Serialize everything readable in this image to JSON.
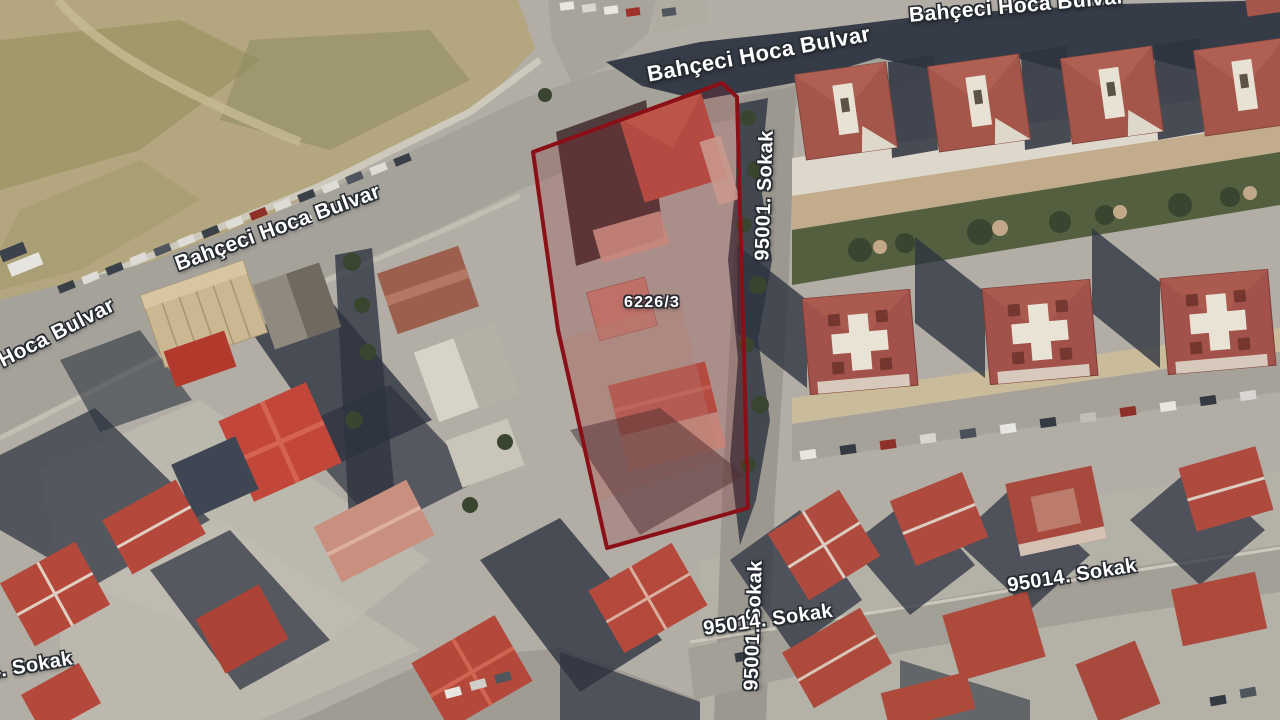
{
  "map": {
    "type": "satellite-cadastral-view",
    "parcel": {
      "id": "6226/3",
      "outline_color": "#8b0f16"
    },
    "streets": {
      "boulevard": "Bahçeci Hoca Bulvar",
      "street_95001": "95001. Sokak",
      "street_95014": "95014. Sokak",
      "corner_fragment": "96"
    },
    "colors": {
      "ground": "#b2aea6",
      "field": "#b4a67e",
      "road": "#a5a29a",
      "shadow": "#2d3340",
      "roof_red": "#b4483a",
      "roof_terracotta": "#a4564a",
      "label_text": "#ffffff"
    }
  }
}
